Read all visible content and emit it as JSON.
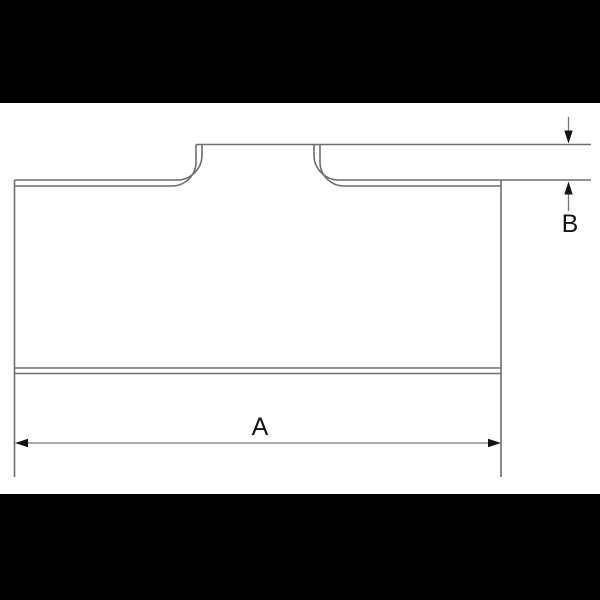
{
  "diagram": {
    "type": "technical-drawing",
    "subject": "Butt-weld pipe tee fitting profile (side view) with dimension callouts",
    "labels": {
      "width_dimension": "A",
      "branch_height_dimension": "B"
    },
    "colors": {
      "background": "#ffffff",
      "letterbox_bar": "#000000",
      "outline_stroke": "#6e6e6e",
      "dimension_stroke": "#787878",
      "arrow_fill": "#141414",
      "text": "#161616"
    },
    "elements": {
      "body": "main run body rectangle with double-line top and bottom walls",
      "branch": "center-left branch stub with filleted crotch curves",
      "dimension_a": "horizontal overall-length dimension line with outward arrowheads at bottom",
      "dimension_b": "vertical stub-height dimension with opposing arrows at right"
    }
  }
}
